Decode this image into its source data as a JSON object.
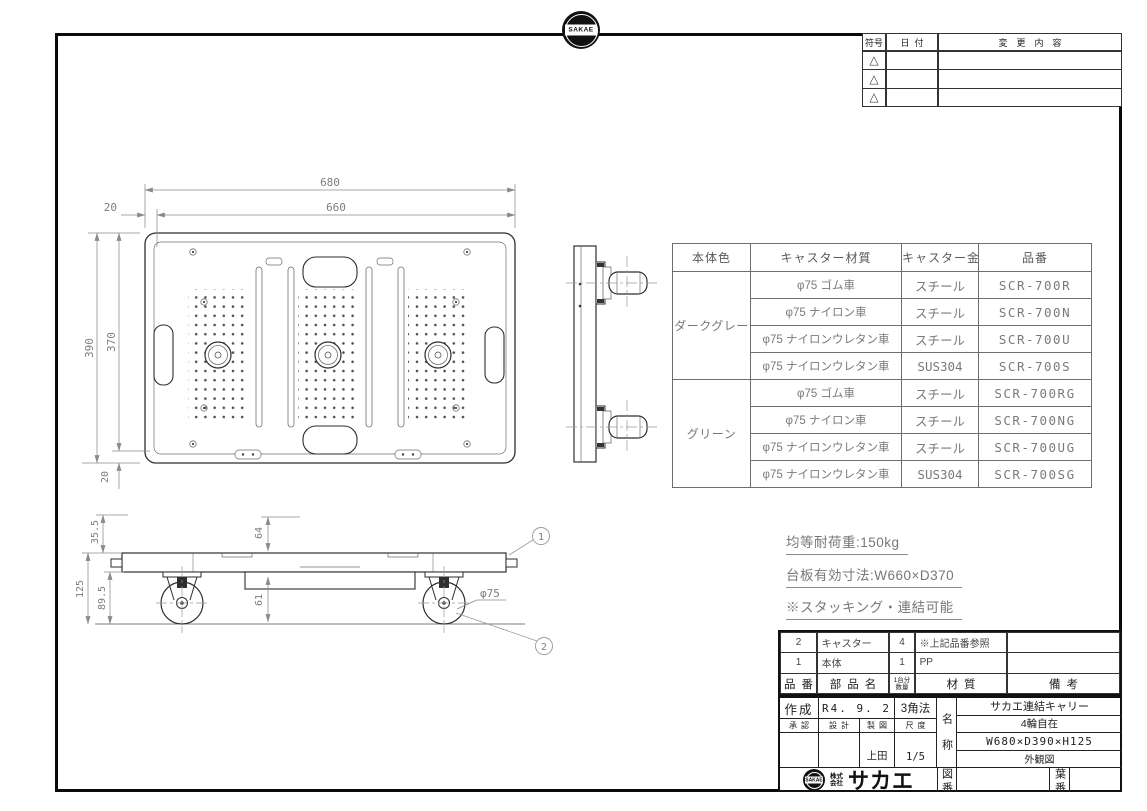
{
  "logo": {
    "badge_text": "SAKAE"
  },
  "revision_table": {
    "headers": [
      "符号",
      "日付",
      "変更内容"
    ],
    "rows": [
      {
        "symbol": "△"
      },
      {
        "symbol": "△"
      },
      {
        "symbol": "△"
      }
    ]
  },
  "variant_table": {
    "headers": [
      "本体色",
      "キャスター材質",
      "キャスター金具",
      "品番"
    ],
    "groups": [
      {
        "color": "ダークグレー",
        "rows": [
          {
            "material": "φ75 ゴム車",
            "fitting": "スチール",
            "code": "SCR-700R"
          },
          {
            "material": "φ75 ナイロン車",
            "fitting": "スチール",
            "code": "SCR-700N"
          },
          {
            "material": "φ75 ナイロンウレタン車",
            "fitting": "スチール",
            "code": "SCR-700U"
          },
          {
            "material": "φ75 ナイロンウレタン車",
            "fitting": "SUS304",
            "code": "SCR-700S"
          }
        ]
      },
      {
        "color": "グリーン",
        "rows": [
          {
            "material": "φ75 ゴム車",
            "fitting": "スチール",
            "code": "SCR-700RG"
          },
          {
            "material": "φ75 ナイロン車",
            "fitting": "スチール",
            "code": "SCR-700NG"
          },
          {
            "material": "φ75 ナイロンウレタン車",
            "fitting": "スチール",
            "code": "SCR-700UG"
          },
          {
            "material": "φ75 ナイロンウレタン車",
            "fitting": "SUS304",
            "code": "SCR-700SG"
          }
        ]
      }
    ]
  },
  "notes": {
    "load": "均等耐荷重:150kg",
    "deck": "台板有効寸法:W660×D370",
    "stack": "※スタッキング・連結可能"
  },
  "dims": {
    "w680": "680",
    "w660": "660",
    "off20_top": "20",
    "h390": "390",
    "h370": "370",
    "off20_bottom": "20",
    "t355": "35.5",
    "t125": "125",
    "t895": "89.5",
    "t64": "64",
    "t61": "61",
    "wheel_dia": "φ75"
  },
  "balloons": {
    "b1": "1",
    "b2": "2"
  },
  "parts_list": {
    "headers": {
      "no": "品番",
      "name": "部品名",
      "qty1": "1台分",
      "qty2": "数量",
      "material": "材質",
      "note": "備考"
    },
    "rows": [
      {
        "no": "2",
        "name": "キャスター",
        "qty": "4",
        "material": "※上記品番参照",
        "note": ""
      },
      {
        "no": "1",
        "name": "本体",
        "qty": "1",
        "material": "PP",
        "note": ""
      }
    ]
  },
  "title_block": {
    "created_label": "作成",
    "created_value": "R4. 9. 2",
    "projection": "3角法",
    "approve_label": "承認",
    "design_label": "設計",
    "draft_label": "製図",
    "scale_label": "尺度",
    "drafter": "上田",
    "scale_value": "1/5",
    "name_label": "名称",
    "product_name": "サカエ連結キャリー",
    "spec1": "4輪自在",
    "spec2": "W680×D390×H125",
    "spec3": "外観図",
    "drawing_no_label": "図番",
    "sheet_no_label": "葉番",
    "company_prefix1": "株式",
    "company_prefix2": "会社",
    "company_name": "サカエ"
  }
}
